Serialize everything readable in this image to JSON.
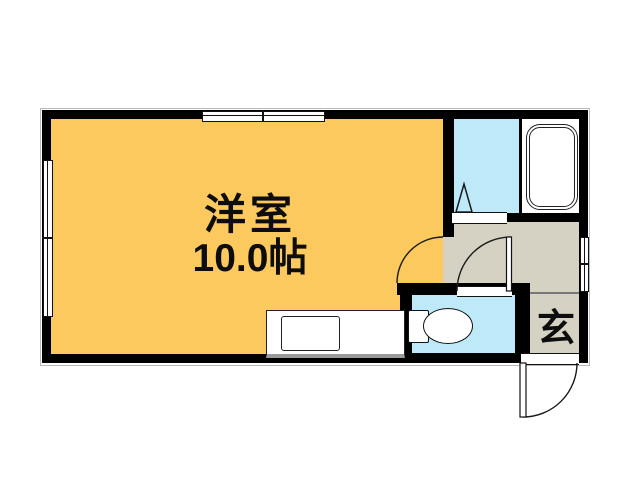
{
  "plan": {
    "type": "japanese-apartment-floor-plan",
    "rooms": {
      "main_room": {
        "name": "洋室",
        "size": "10.0帖",
        "floor_color": "#FBC95D"
      },
      "bathroom": {
        "name": "bathroom-washroom",
        "floor_color": "#BDE9F8"
      },
      "toilet_room": {
        "name": "toilet-room",
        "floor_color": "#BDE9F8"
      },
      "hallway": {
        "name": "hallway",
        "floor_color": "#D5D1C3"
      },
      "entrance": {
        "label": "玄",
        "floor_color": "#D5D1C3"
      }
    },
    "fixtures": [
      {
        "name": "bathtub"
      },
      {
        "name": "toilet"
      },
      {
        "name": "kitchen-counter"
      },
      {
        "name": "kitchen-sink"
      },
      {
        "name": "window-top"
      },
      {
        "name": "window-left"
      },
      {
        "name": "window-right"
      },
      {
        "name": "main-room-door-swing"
      },
      {
        "name": "toilet-door-swing"
      },
      {
        "name": "entrance-door-swing"
      },
      {
        "name": "bathroom-folding-door"
      }
    ]
  },
  "colors": {
    "wall": "#000000",
    "room_main": "#FBC95D",
    "room_wet": "#BDE9F8",
    "room_hall": "#D5D1C3",
    "line": "#1a1a1a"
  }
}
